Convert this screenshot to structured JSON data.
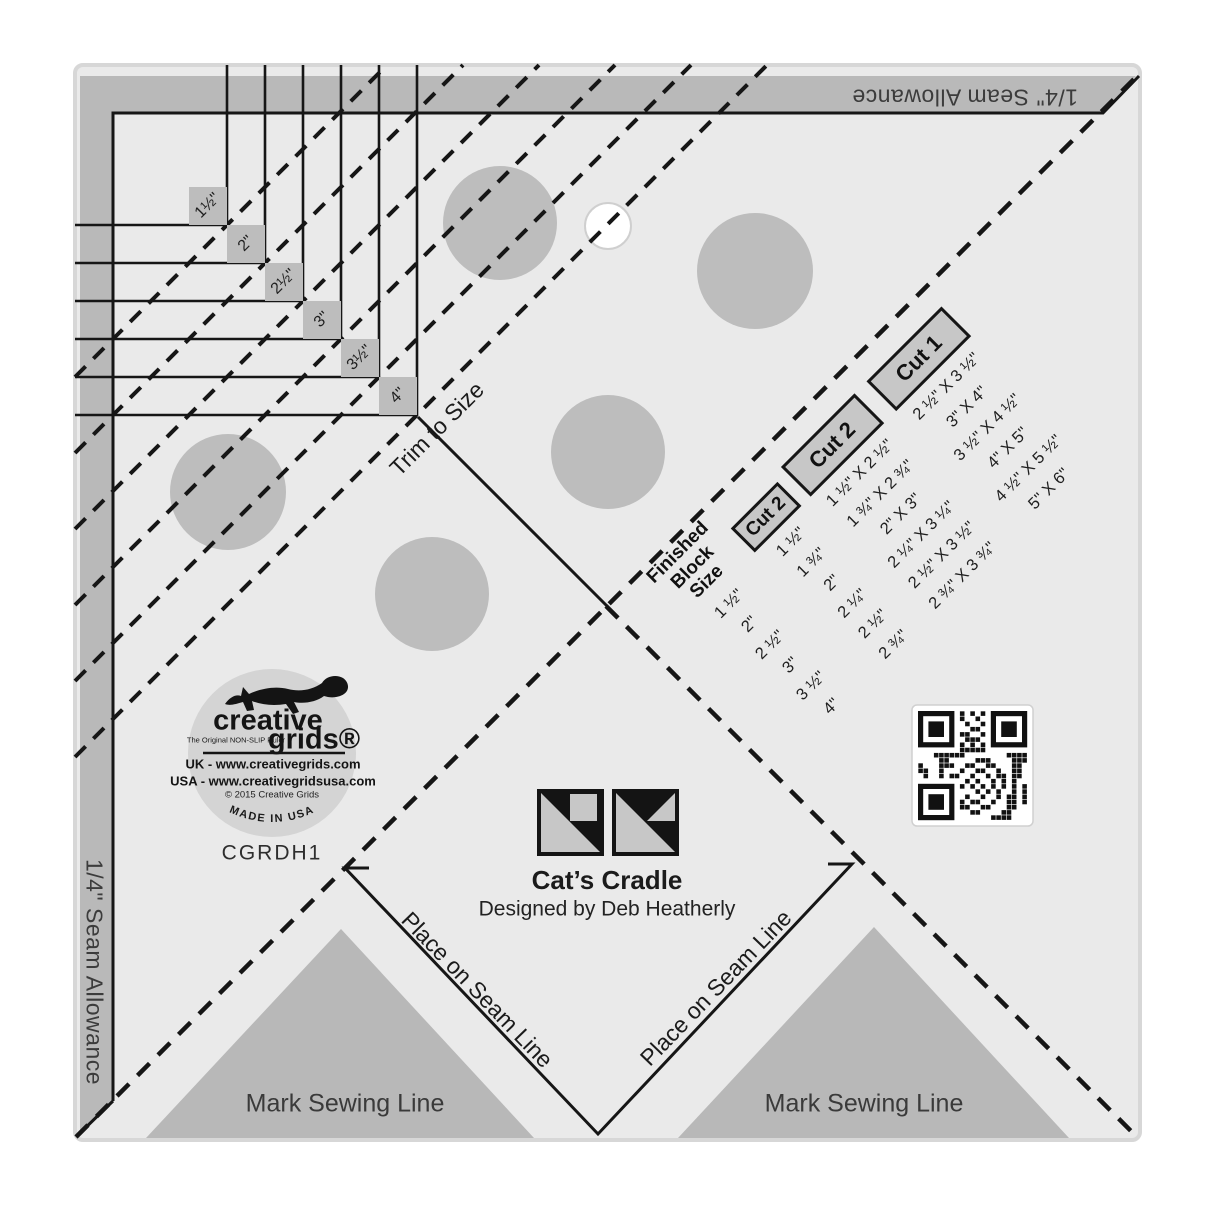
{
  "labels": {
    "seam_allowance_top": "1/4\" Seam Allowance",
    "seam_allowance_left": "1/4\" Seam Allowance",
    "trim_to_size": "Trim to Size",
    "place_on_seam_line_left": "Place on Seam Line",
    "place_on_seam_line_right": "Place on Seam Line",
    "mark_sewing_line_left": "Mark Sewing Line",
    "mark_sewing_line_right": "Mark Sewing Line",
    "title": "Cat’s Cradle",
    "designer": "Designed by Deb Heatherly",
    "product_code": "CGRDH1"
  },
  "ruler": {
    "size_labels": [
      "1½\"",
      "2\"",
      "2½\"",
      "3\"",
      "3½\"",
      "4\""
    ]
  },
  "cut_table": {
    "header": {
      "line1": "Finished",
      "line2": "Block Size"
    },
    "col_labels": [
      "Cut 2",
      "Cut 2",
      "Cut 1"
    ],
    "rows": [
      {
        "finished": "1 ½\"",
        "cut2a": "1 ½\"",
        "cut2b": "1 ½\" X 2 ½\"",
        "cut1": "2 ½\" X 3 ½\""
      },
      {
        "finished": "2\"",
        "cut2a": "1 ¾\"",
        "cut2b": "1 ¾\" X 2 ¾\"",
        "cut1": "3\" X 4\""
      },
      {
        "finished": "2 ½\"",
        "cut2a": "2\"",
        "cut2b": "2\" X 3\"",
        "cut1": "3 ½\" X 4 ½\""
      },
      {
        "finished": "3\"",
        "cut2a": "2 ¼\"",
        "cut2b": "2 ¼\" X 3 ¼\"",
        "cut1": "4\" X 5\""
      },
      {
        "finished": "3 ½\"",
        "cut2a": "2 ½\"",
        "cut2b": "2 ½\" X 3 ½\"",
        "cut1": "4 ½\" X 5 ½\""
      },
      {
        "finished": "4\"",
        "cut2a": "2 ¾\"",
        "cut2b": "2 ¾\" X 3 ¾\"",
        "cut1": "5\" X 6\""
      }
    ]
  },
  "logo": {
    "brand_top": "creative",
    "brand_bottom": "grids®",
    "tagline": "The Original NON-SLIP Ruler",
    "uk": "UK - www.creativegrids.com",
    "usa": "USA - www.creativegridsusa.com",
    "copyright": "© 2015 Creative Grids",
    "made_in": "MADE IN USA"
  },
  "colors": {
    "body": "#eaeaea",
    "edge": "#d7d7d7",
    "band": "#b9b9b9",
    "dot": "#bdbdbd",
    "tri": "#b8b8b8",
    "tag": "#bdbdbd",
    "logo": "#d4d4d4",
    "box": "#c7c7c7",
    "ink": "#161616",
    "text": "#2e2e2e"
  }
}
